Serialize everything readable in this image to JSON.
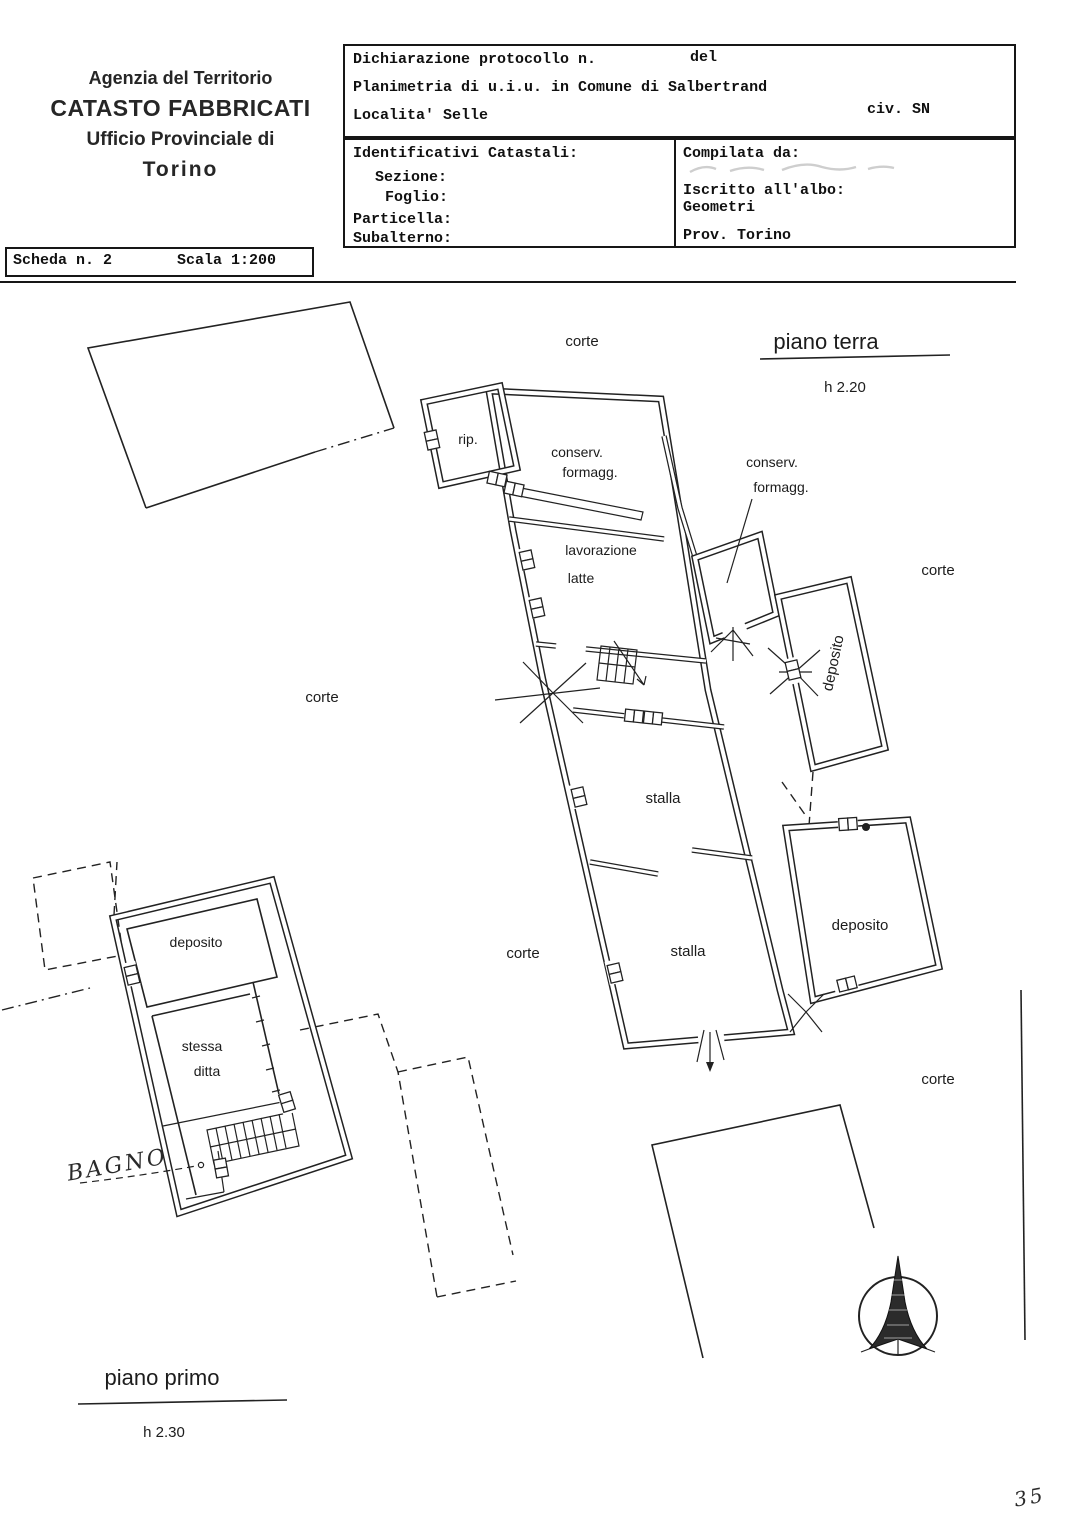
{
  "header": {
    "agency": {
      "line1": "Agenzia del Territorio",
      "line2": "CATASTO FABBRICATI",
      "line3": "Ufficio Provinciale di",
      "line4": "Torino"
    },
    "declaration": {
      "protocol_label": "Dichiarazione protocollo n.",
      "del_label": "del",
      "planimetria": "Planimetria di u.i.u. in Comune di Salbertrand",
      "localita": "Localita' Selle",
      "civ": "civ. SN"
    },
    "identifiers": {
      "title": "Identificativi Catastali:",
      "sezione": "Sezione:",
      "foglio": "Foglio:",
      "particella": "Particella:",
      "subalterno": "Subalterno:"
    },
    "compiled": {
      "title": "Compilata da:",
      "albo": "Iscritto all'albo:",
      "albo_value": "Geometri",
      "prov": "Prov. Torino"
    }
  },
  "scheda": {
    "number": "Scheda n. 2",
    "scale": "Scala 1:200"
  },
  "plan": {
    "floor_ground": {
      "title": "piano terra",
      "height": "h 2.20"
    },
    "floor_first": {
      "title": "piano primo",
      "height": "h 2.30"
    },
    "labels": {
      "corte_top": "corte",
      "corte_left": "corte",
      "corte_right_upper": "corte",
      "corte_center": "corte",
      "corte_right_lower": "corte",
      "rip": "rip.",
      "conserv_line1": "conserv.",
      "conserv_line2": "formagg.",
      "conserv2_line1": "conserv.",
      "conserv2_line2": "formagg.",
      "lavorazione": "lavorazione",
      "latte": "latte",
      "stalla_upper": "stalla",
      "stalla_lower": "stalla",
      "deposito_side": "deposito",
      "deposito_lower": "deposito",
      "deposito_left": "deposito",
      "stessa": "stessa",
      "ditta": "ditta",
      "bagno": "BAGNO"
    },
    "page_number": "35"
  }
}
